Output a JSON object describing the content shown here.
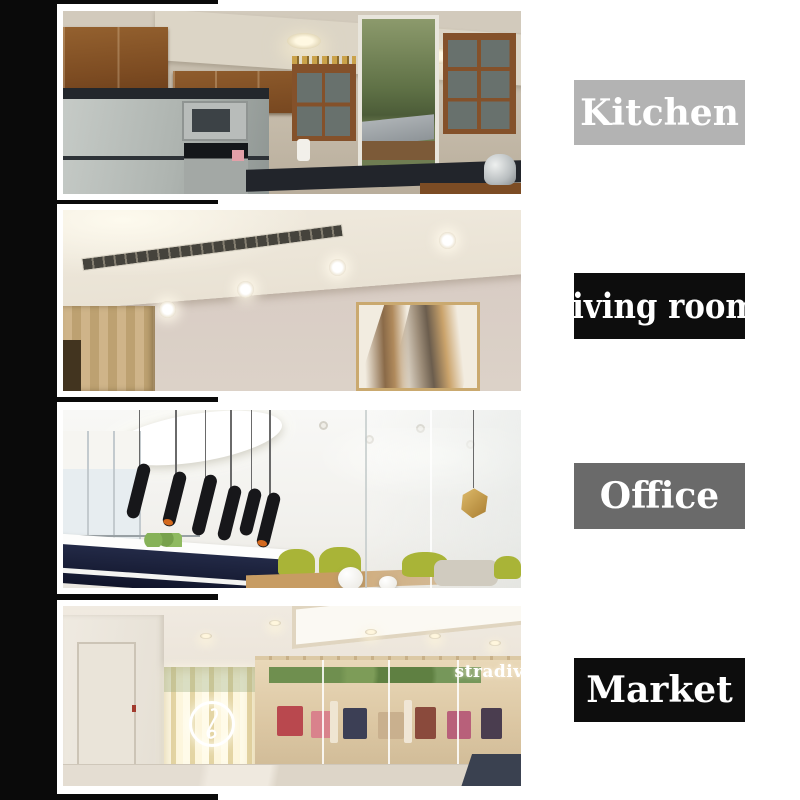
{
  "page": {
    "background": "#ffffff",
    "accent_color": "#0a0a0a",
    "label_text_color": "#ffffff"
  },
  "sections": [
    {
      "id": "kitchen",
      "label": "Kitchen",
      "label_bg": "#b3b3b3",
      "photo_description": "kitchen with wooden cabinets, stainless fridge, microwave, stove and window"
    },
    {
      "id": "living-room",
      "label": "living room",
      "label_bg": "#0d0d0d",
      "photo_description": "living room ceiling with recessed downlights, linear vent, wood panel and abstract wall art"
    },
    {
      "id": "office",
      "label": "Office",
      "label_bg": "#6a6a6a",
      "photo_description": "white office lobby with black cylinder pendant lights, reception desk and lime chairs"
    },
    {
      "id": "market",
      "label": "Market",
      "label_bg": "#0d0d0d",
      "photo_description": "shopping mall storefront with LED light wall, neon clef sign and clothing shop",
      "storefront_sign": "stradiv"
    }
  ]
}
